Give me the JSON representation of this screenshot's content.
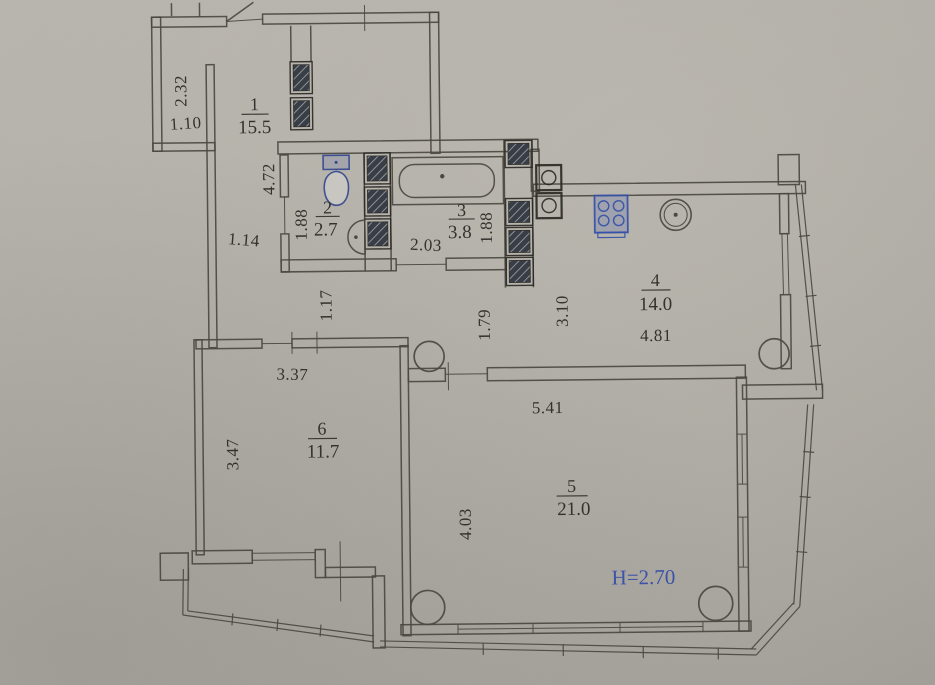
{
  "document": {
    "kind": "apartment floor plan photo",
    "ceiling_height_note": "H=2.70"
  },
  "colors": {
    "paper": "#b1aea7",
    "ink": "#4a4640",
    "text_ink": "#34322d",
    "blue_accent": "#3d52a8",
    "shaft_fill": "#383e48"
  },
  "rooms": [
    {
      "number": "1",
      "area": "15.5"
    },
    {
      "number": "2",
      "area": "2.7"
    },
    {
      "number": "3",
      "area": "3.8"
    },
    {
      "number": "4",
      "area": "14.0"
    },
    {
      "number": "5",
      "area": "21.0"
    },
    {
      "number": "6",
      "area": "11.7"
    }
  ],
  "dims": {
    "entry_niche_h": "2.32",
    "entry_niche_w": "1.10",
    "hall_v": "4.72",
    "wc_v": "1.88",
    "corridor_w": "1.14",
    "bath_w": "2.03",
    "bath_v": "1.88",
    "hall_lower_v": "1.17",
    "pass_v": "1.79",
    "kitchen_v": "3.10",
    "kitchen_w": "4.81",
    "room6_w": "3.37",
    "room6_v": "3.47",
    "room5_w": "5.41",
    "room5_v": "4.03"
  },
  "annotations": {
    "ceiling_height": "H=2.70"
  }
}
